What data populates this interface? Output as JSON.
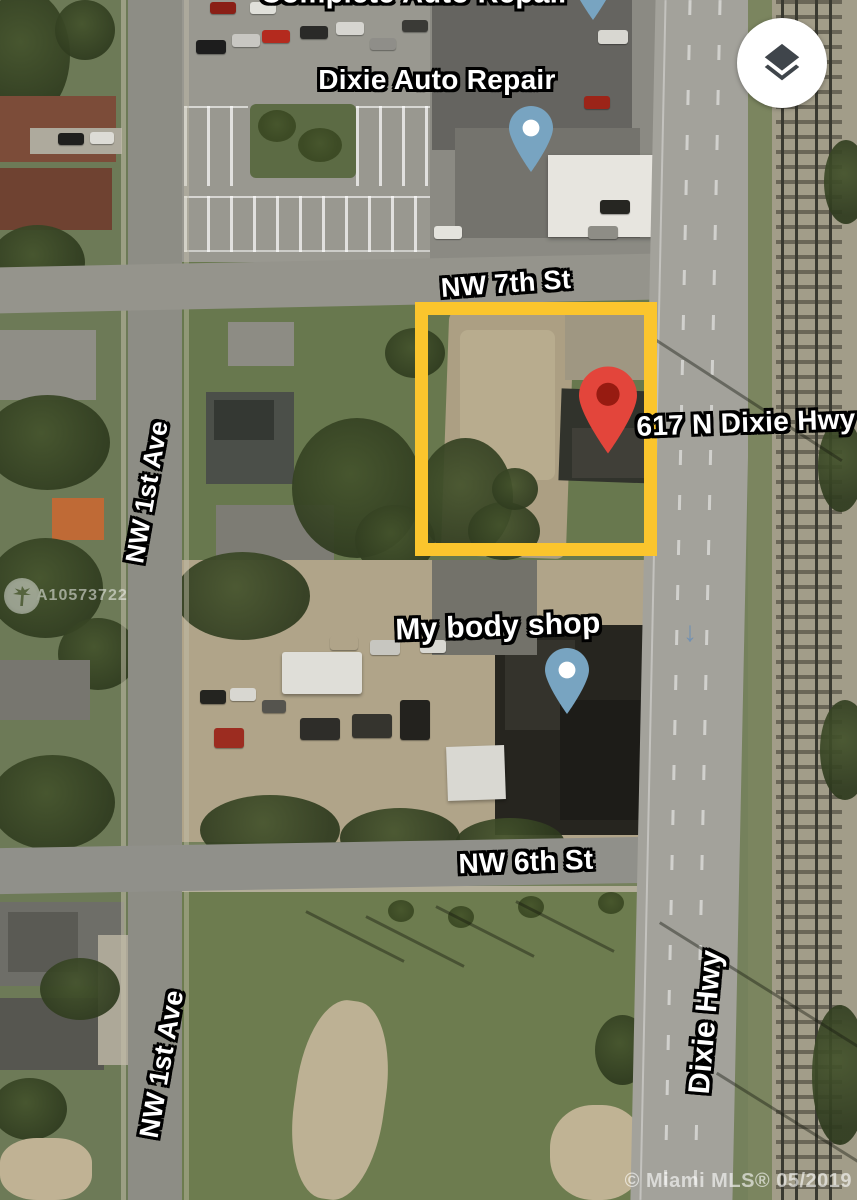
{
  "map": {
    "type": "satellite",
    "partial_top_label": "Complete Auto Repair",
    "poi": {
      "dixie_auto_repair": "Dixie Auto Repair",
      "my_body_shop": "My body shop"
    },
    "marker": {
      "label": "617 N Dixie Hwy"
    },
    "streets": {
      "nw_7th": "NW 7th St",
      "nw_6th": "NW 6th St",
      "nw_1st_upper": "NW 1st Ave",
      "nw_1st_lower": "NW 1st Ave",
      "dixie_hwy": "Dixie Hwy"
    },
    "one_way_arrow": "↓",
    "watermark": {
      "mls_number": "A10573722"
    },
    "copyright": "© Miami MLS® 05/2019",
    "colors": {
      "highlight_box": "#FBC52D",
      "marker_red": "#E3453B",
      "marker_red_inner": "#971B11",
      "poi_pin_blue": "#78A4C1",
      "layers_icon": "#3F454B"
    }
  }
}
